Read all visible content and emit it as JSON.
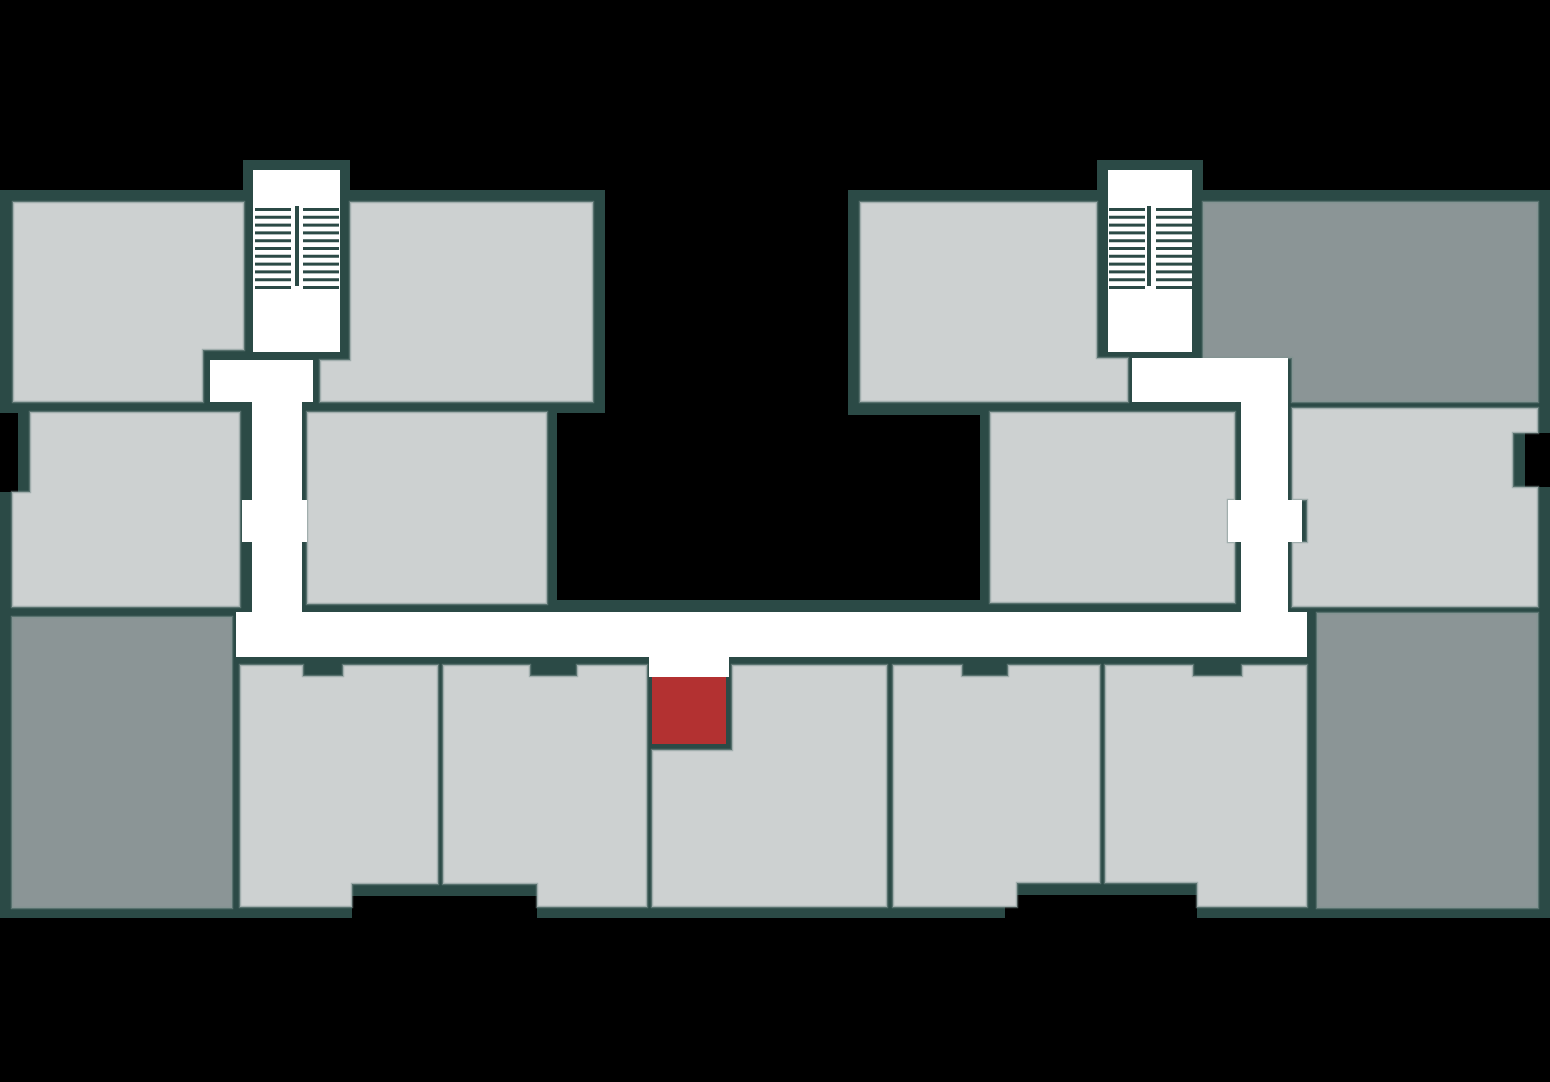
{
  "floorplan": {
    "description": "building-floor-plan",
    "colors": {
      "background": "#000000",
      "wall": "#2b4a46",
      "corridor": "#ffffff",
      "unit_light": "#cdd1d1",
      "unit_dark": "#8b9596",
      "unit_highlight": "#b33131"
    },
    "units": [
      {
        "id": "unit-top-left",
        "variant": "light"
      },
      {
        "id": "unit-mid-left",
        "variant": "light"
      },
      {
        "id": "unit-top-left-2",
        "variant": "light"
      },
      {
        "id": "unit-inner-left",
        "variant": "light"
      },
      {
        "id": "unit-wing2-left",
        "variant": "light"
      },
      {
        "id": "unit-wing2-mid",
        "variant": "light"
      },
      {
        "id": "unit-right-mid",
        "variant": "light"
      },
      {
        "id": "unit-bottom-1",
        "variant": "light"
      },
      {
        "id": "unit-bottom-2",
        "variant": "light"
      },
      {
        "id": "unit-bottom-3",
        "variant": "light"
      },
      {
        "id": "unit-bottom-4",
        "variant": "light"
      },
      {
        "id": "unit-bottom-5",
        "variant": "light"
      },
      {
        "id": "unit-dark-bottom-left",
        "variant": "dark"
      },
      {
        "id": "unit-dark-top-right",
        "variant": "dark"
      },
      {
        "id": "unit-dark-bottom-right",
        "variant": "dark"
      },
      {
        "id": "unit-highlighted",
        "variant": "highlight",
        "state": "selected"
      }
    ],
    "stairwells": [
      {
        "id": "stairwell-left"
      },
      {
        "id": "stairwell-right"
      }
    ]
  }
}
